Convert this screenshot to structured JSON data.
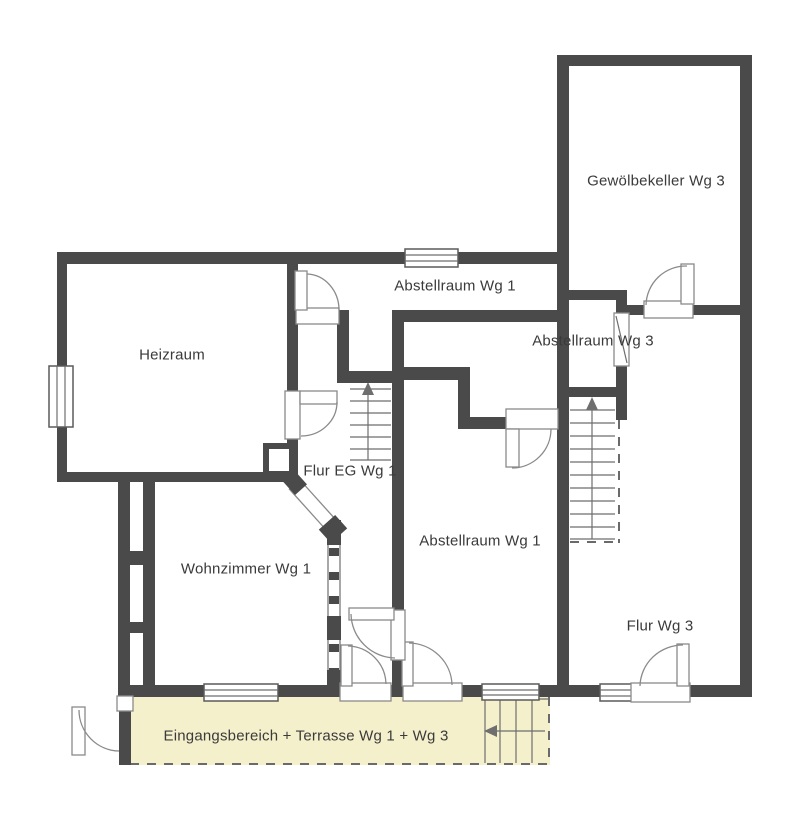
{
  "floorplan": {
    "rooms": [
      {
        "id": "gewoelbekeller",
        "label": "Gewölbekeller Wg 3"
      },
      {
        "id": "abstellraum_wg1_oben",
        "label": "Abstellraum Wg 1"
      },
      {
        "id": "heizraum",
        "label": "Heizraum"
      },
      {
        "id": "abstellraum_wg3",
        "label": "Abstellraum Wg 3"
      },
      {
        "id": "flur_eg_wg1",
        "label": "Flur EG Wg 1"
      },
      {
        "id": "abstellraum_wg1_mitte",
        "label": "Abstellraum Wg 1"
      },
      {
        "id": "wohnzimmer_wg1",
        "label": "Wohnzimmer Wg 1"
      },
      {
        "id": "flur_wg3",
        "label": "Flur Wg 3"
      },
      {
        "id": "eingang_terrasse",
        "label": "Eingangsbereich + Terrasse Wg 1 + Wg 3"
      }
    ],
    "colors": {
      "wall": "#4a4a4a",
      "terrace_fill": "#f5f0cc",
      "background": "#ffffff",
      "text": "#3a3a3a"
    },
    "symbols": {
      "staircase_wg1_direction": "up",
      "staircase_wg3_direction": "up",
      "exterior_steps_direction": "left"
    }
  }
}
